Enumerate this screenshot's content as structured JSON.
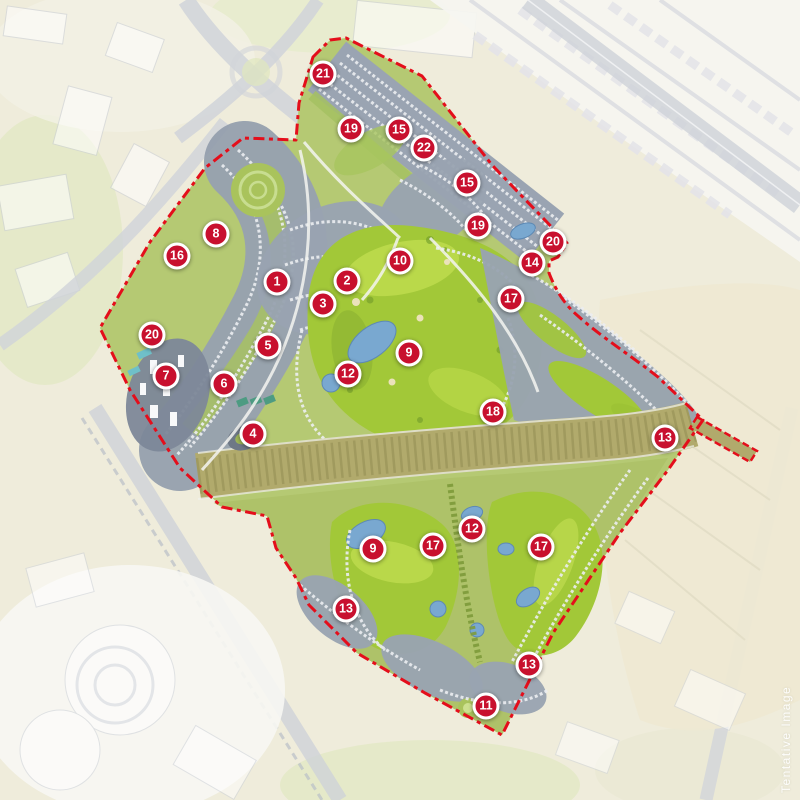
{
  "watermark": {
    "text": "Tentative Image"
  },
  "markers": [
    {
      "label": "1",
      "x": 277,
      "y": 282
    },
    {
      "label": "2",
      "x": 347,
      "y": 281
    },
    {
      "label": "3",
      "x": 323,
      "y": 304
    },
    {
      "label": "4",
      "x": 253,
      "y": 434
    },
    {
      "label": "5",
      "x": 268,
      "y": 346
    },
    {
      "label": "6",
      "x": 224,
      "y": 384
    },
    {
      "label": "7",
      "x": 166,
      "y": 376
    },
    {
      "label": "8",
      "x": 216,
      "y": 234
    },
    {
      "label": "9",
      "x": 409,
      "y": 353
    },
    {
      "label": "9",
      "x": 373,
      "y": 549
    },
    {
      "label": "10",
      "x": 400,
      "y": 261
    },
    {
      "label": "11",
      "x": 486,
      "y": 706
    },
    {
      "label": "12",
      "x": 348,
      "y": 374
    },
    {
      "label": "12",
      "x": 472,
      "y": 529
    },
    {
      "label": "13",
      "x": 665,
      "y": 438
    },
    {
      "label": "13",
      "x": 346,
      "y": 609
    },
    {
      "label": "13",
      "x": 529,
      "y": 665
    },
    {
      "label": "14",
      "x": 532,
      "y": 263
    },
    {
      "label": "15",
      "x": 399,
      "y": 130
    },
    {
      "label": "15",
      "x": 467,
      "y": 183
    },
    {
      "label": "16",
      "x": 177,
      "y": 256
    },
    {
      "label": "17",
      "x": 511,
      "y": 299
    },
    {
      "label": "17",
      "x": 433,
      "y": 546
    },
    {
      "label": "17",
      "x": 541,
      "y": 547
    },
    {
      "label": "18",
      "x": 493,
      "y": 412
    },
    {
      "label": "19",
      "x": 351,
      "y": 129
    },
    {
      "label": "19",
      "x": 478,
      "y": 226
    },
    {
      "label": "20",
      "x": 553,
      "y": 242
    },
    {
      "label": "20",
      "x": 152,
      "y": 335
    },
    {
      "label": "21",
      "x": 323,
      "y": 74
    },
    {
      "label": "22",
      "x": 424,
      "y": 148
    }
  ],
  "colors": {
    "marker_red": "#c8102e",
    "marker_ring": "#ffffff",
    "boundary_red": "#e40e1b",
    "golf_green": "#a2c838",
    "lake_blue": "#79a8d0",
    "corridor_olive": "#b1aa6c",
    "buildings_gray": "#99a3b1",
    "outside_beige": "#efecdb"
  }
}
